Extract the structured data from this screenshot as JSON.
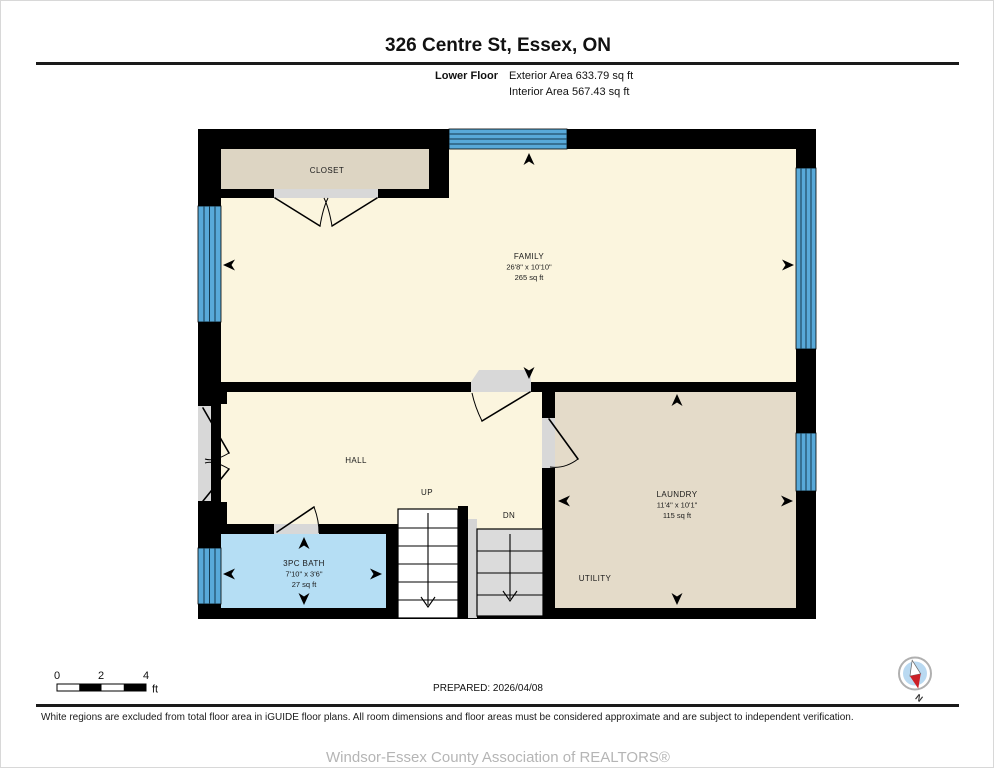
{
  "header": {
    "title": "326 Centre St, Essex, ON",
    "floor_label": "Lower Floor",
    "exterior_area": "Exterior Area 633.79 sq ft",
    "interior_area": "Interior Area 567.43 sq ft"
  },
  "plan": {
    "rooms": {
      "closet": {
        "name": "CLOSET"
      },
      "family": {
        "name": "FAMILY",
        "dims": "26'8\" x 10'10\"",
        "area": "265 sq ft"
      },
      "hall": {
        "name": "HALL"
      },
      "stairs_up": {
        "name": "UP"
      },
      "stairs_down": {
        "name": "DN"
      },
      "bath": {
        "name": "3PC BATH",
        "dims": "7'10\" x 3'6\"",
        "area": "27 sq ft"
      },
      "laundry": {
        "name": "LAUNDRY",
        "dims": "11'4\" x 10'1\"",
        "area": "115 sq ft"
      },
      "utility": {
        "name": "UTILITY"
      }
    },
    "colors": {
      "wall": "#000000",
      "floor_included": "#FBF5DE",
      "closet": "#DDD5C3",
      "laundry": "#E4DBC9",
      "bath": "#B5DEF4",
      "window": "#58A9D9",
      "stairwell_excluded": "#FFFFFF",
      "stairs_down": "#DBDBDB",
      "door_opening": "#D8D8D8"
    }
  },
  "scale_bar": {
    "ticks": [
      "0",
      "2",
      "4"
    ],
    "unit": "ft"
  },
  "prepared_label": "PREPARED: 2026/04/08",
  "compass": {
    "label": "N"
  },
  "disclaimer": "White regions are excluded from total floor area in iGUIDE floor plans. All room dimensions and floor areas must be considered approximate and are subject to independent verification.",
  "footer": {
    "association": "Windsor-Essex County Association of REALTORS®"
  }
}
